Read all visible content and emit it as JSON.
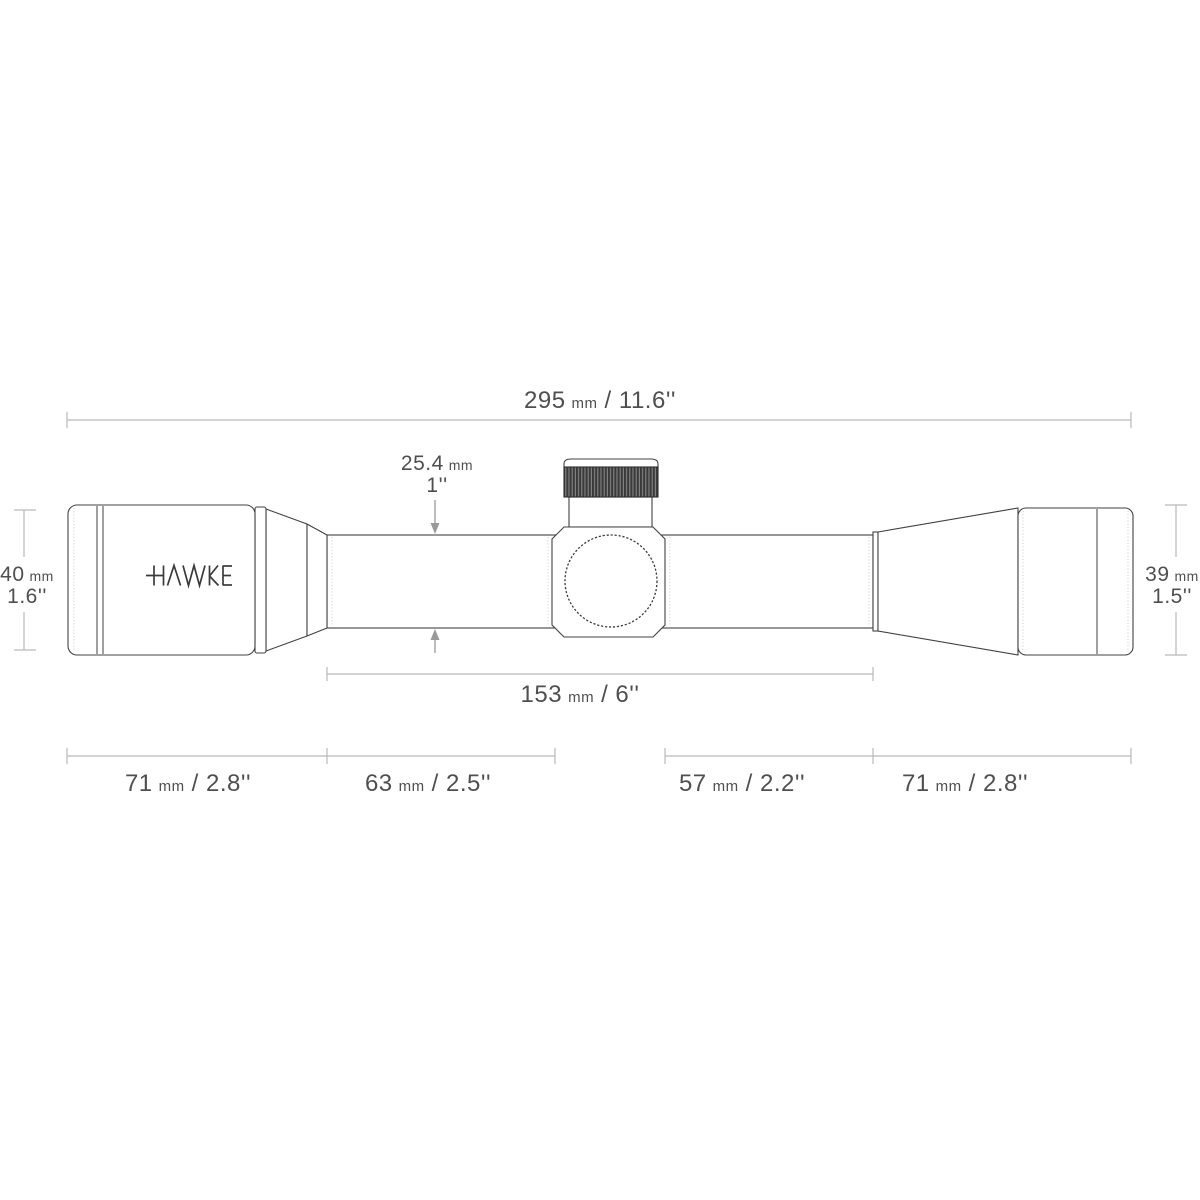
{
  "colors": {
    "background": "#ffffff",
    "outline": "#424242",
    "dim-line": "#b9b9b9",
    "arrow": "#999999",
    "text": "#4f4f4f",
    "shade": "#c9c9c9",
    "knurl-dark": "#3a3a3a",
    "knurl-light": "#8d8d8d"
  },
  "brand": {
    "logo": "HAWKE"
  },
  "labels": {
    "overall_length": {
      "num": "295",
      "unit": "mm",
      "rest": "/ 11.6''"
    },
    "tube_diameter": {
      "num": "25.4",
      "unit": "mm",
      "line2": "1''"
    },
    "eyepiece_diameter": {
      "num": "40",
      "unit": "mm",
      "line2": "1.6''"
    },
    "objective_diameter": {
      "num": "39",
      "unit": "mm",
      "line2": "1.5''"
    },
    "mount_length": {
      "num": "153",
      "unit": "mm",
      "rest": "/ 6''"
    },
    "segment_eyepiece": {
      "num": "71",
      "unit": "mm",
      "rest": "/ 2.8''"
    },
    "segment_saddle_left": {
      "num": "63",
      "unit": "mm",
      "rest": "/ 2.5''"
    },
    "segment_saddle_right": {
      "num": "57",
      "unit": "mm",
      "rest": "/ 2.2''"
    },
    "segment_objective_bell": {
      "num": "71",
      "unit": "mm",
      "rest": "/ 2.8''"
    }
  }
}
